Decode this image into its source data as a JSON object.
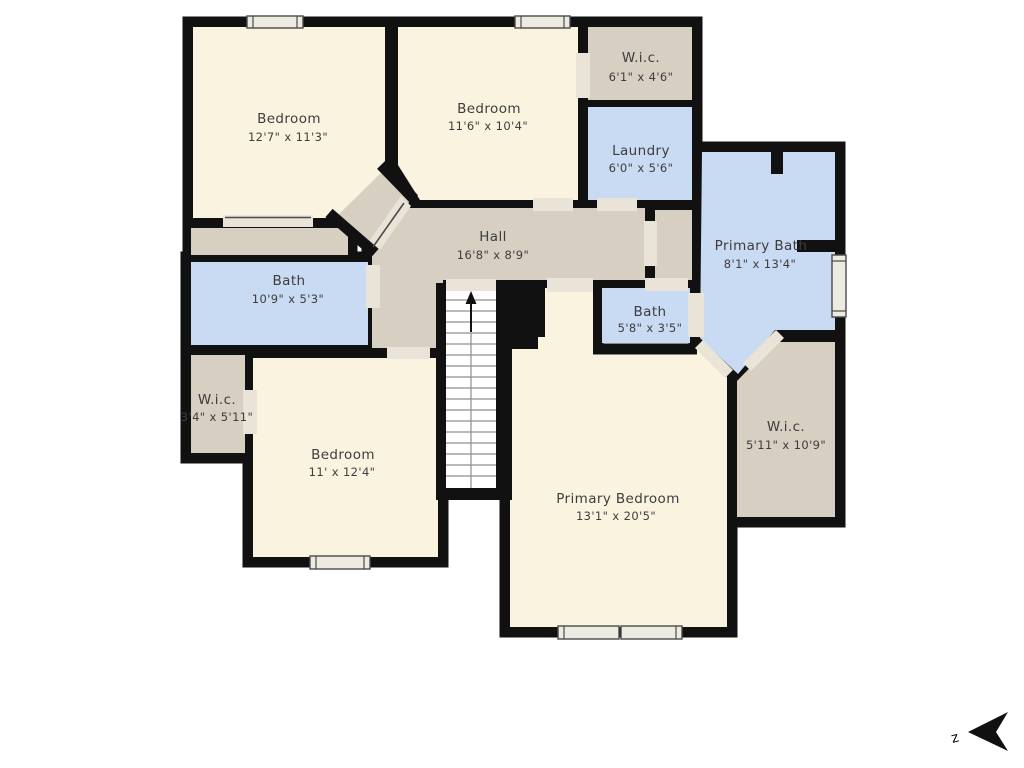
{
  "rooms": [
    {
      "id": "bedroom-top-left",
      "name": "Bedroom",
      "dims": "12'7\" x 11'3\""
    },
    {
      "id": "bedroom-top",
      "name": "Bedroom",
      "dims": "11'6\" x 10'4\""
    },
    {
      "id": "wic-top-right",
      "name": "W.i.c.",
      "dims": "6'1\" x 4'6\""
    },
    {
      "id": "laundry",
      "name": "Laundry",
      "dims": "6'0\" x 5'6\""
    },
    {
      "id": "hall",
      "name": "Hall",
      "dims": "16'8\" x 8'9\""
    },
    {
      "id": "primary-bath",
      "name": "Primary Bath",
      "dims": "8'1\" x 13'4\""
    },
    {
      "id": "bath",
      "name": "Bath",
      "dims": "10'9\" x 5'3\""
    },
    {
      "id": "bath-small",
      "name": "Bath",
      "dims": "5'8\" x 3'5\""
    },
    {
      "id": "wic-left",
      "name": "W.i.c.",
      "dims": "3'4\" x 5'11\""
    },
    {
      "id": "bedroom-bottom-left",
      "name": "Bedroom",
      "dims": "11' x 12'4\""
    },
    {
      "id": "primary-bedroom",
      "name": "Primary Bedroom",
      "dims": "13'1\" x 20'5\""
    },
    {
      "id": "wic-bottom-right",
      "name": "W.i.c.",
      "dims": "5'11\" x 10'9\""
    }
  ],
  "compass": {
    "label": "z"
  },
  "colors": {
    "wall": "#111111",
    "room_fill": "#faf3df",
    "wet_room_fill": "#c9daf3",
    "hall_fill": "#d7cfc2",
    "threshold": "#e9e3d8",
    "window": "#edeae1",
    "background": "#ffffff",
    "label_text": "#3d3d3d"
  }
}
